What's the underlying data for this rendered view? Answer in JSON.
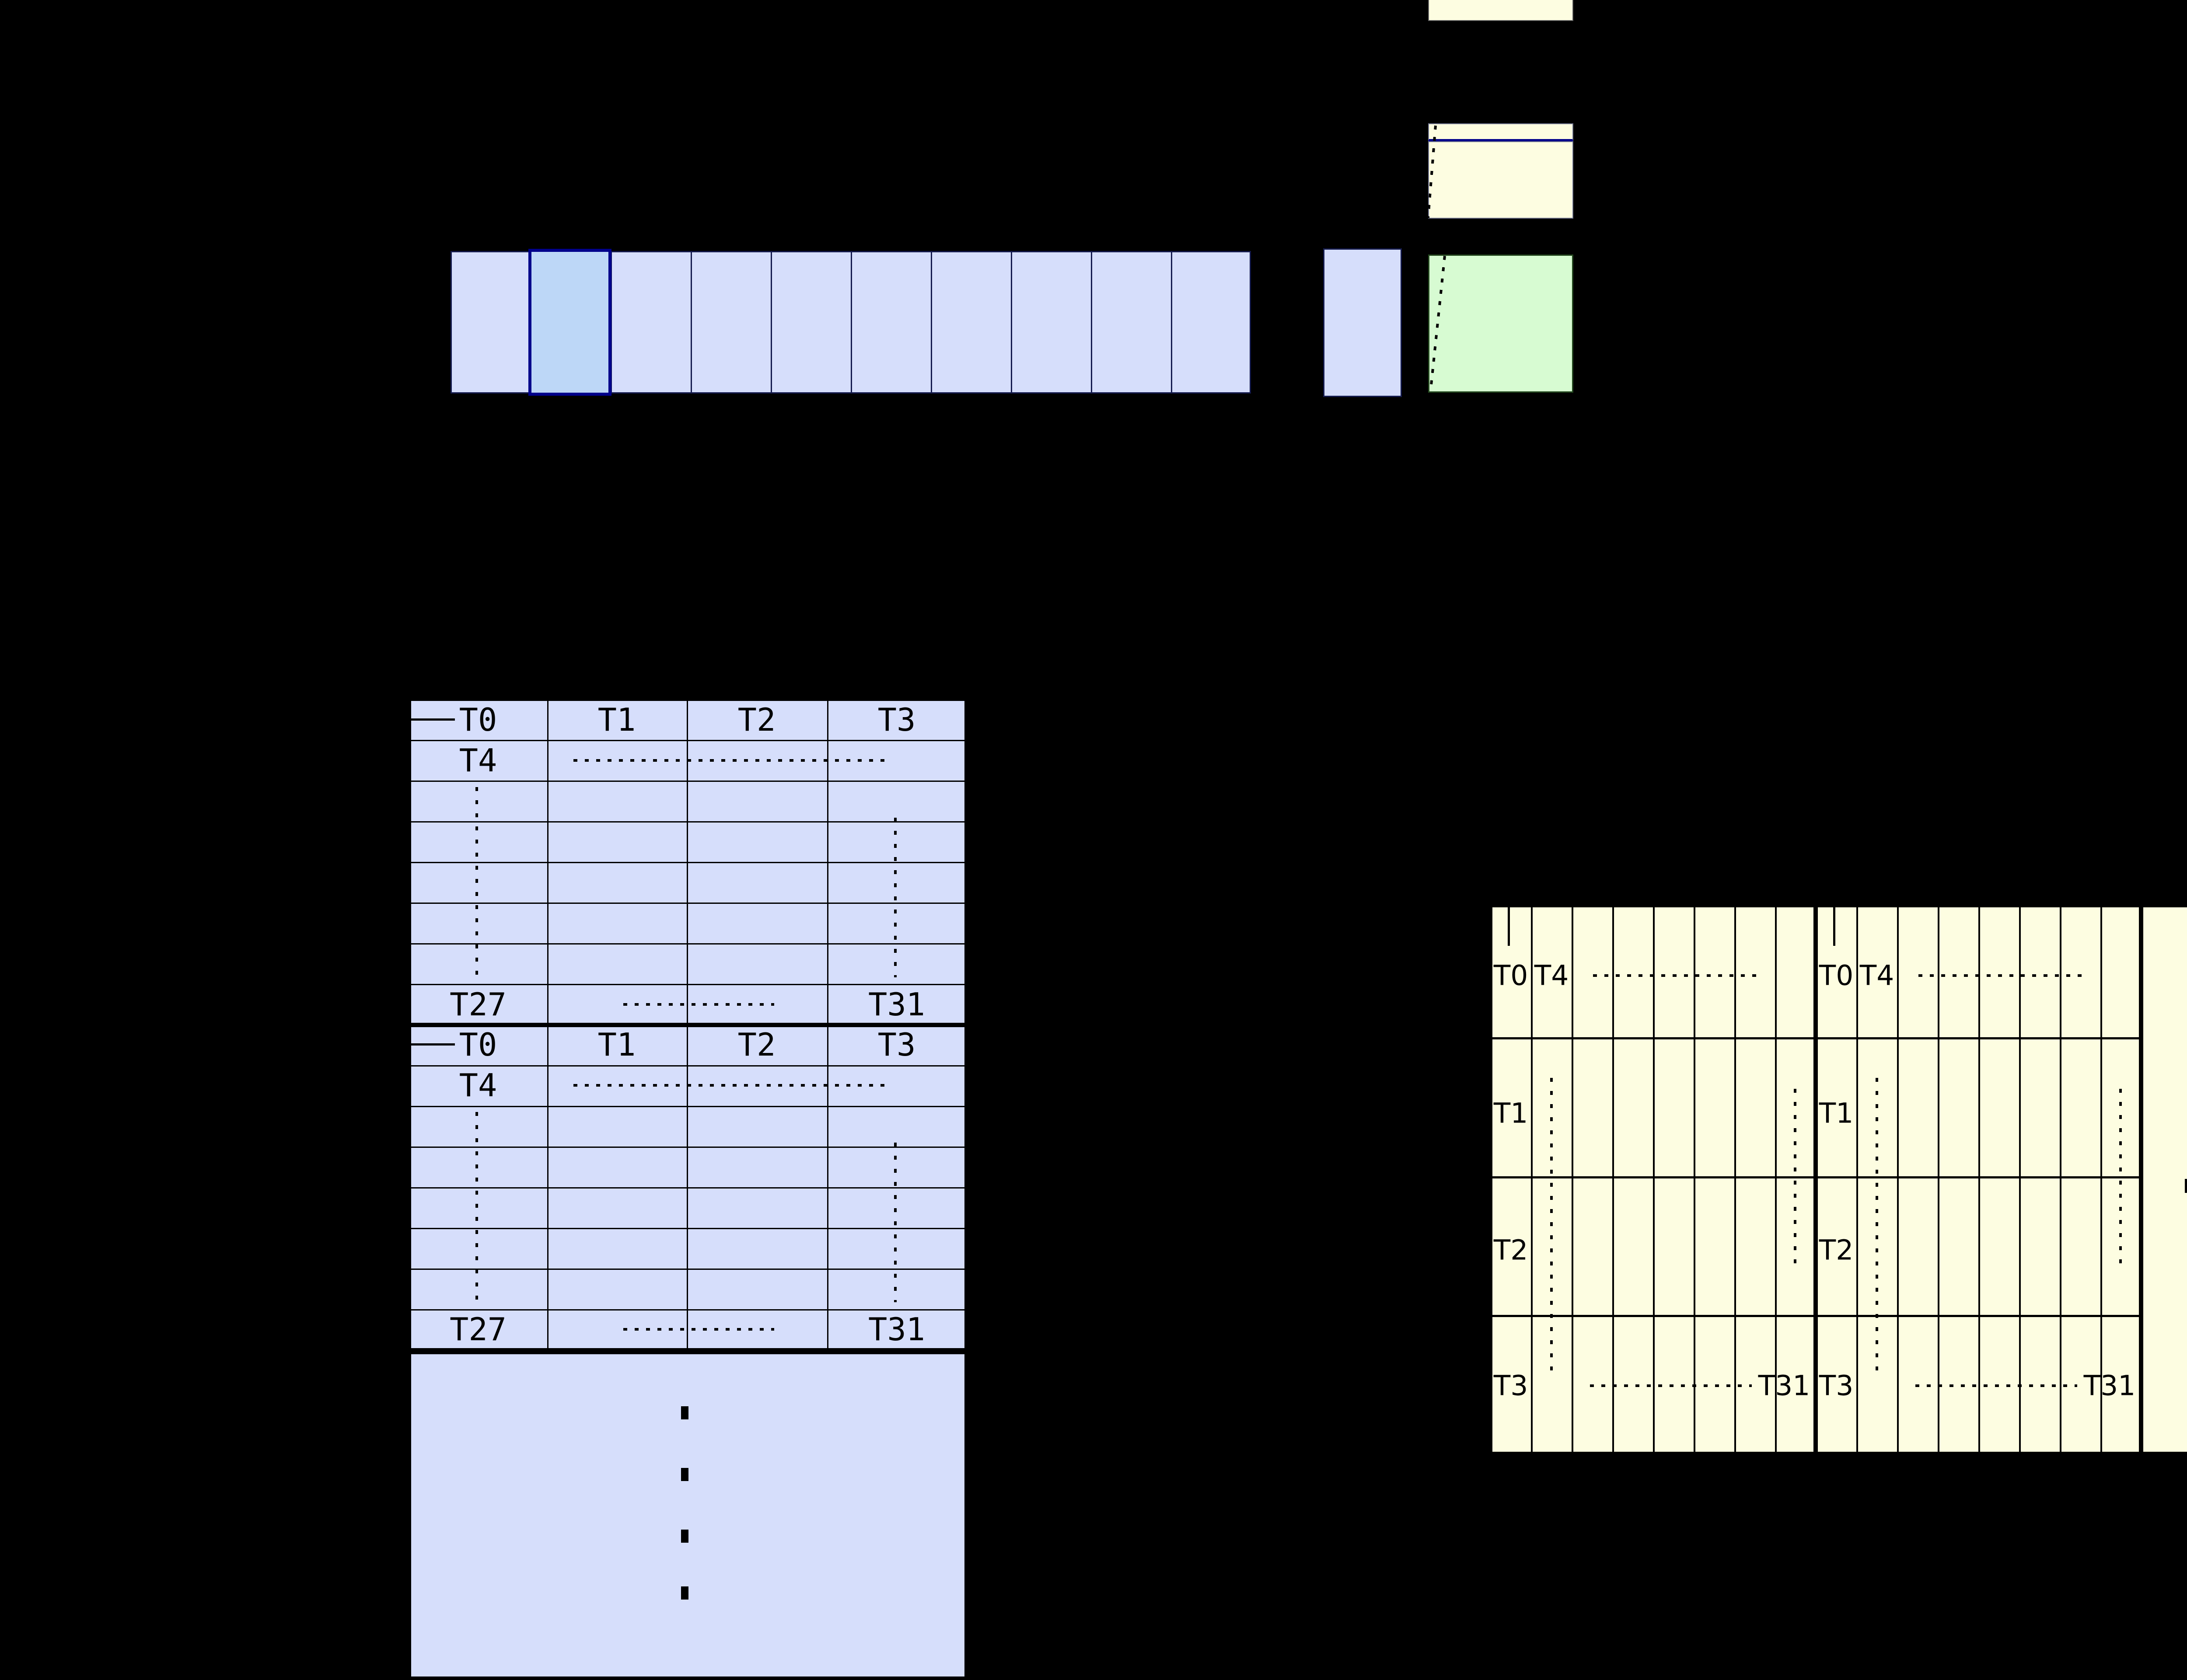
{
  "diagram": {
    "background": "#000000",
    "colors": {
      "cell_blue": "#d6defb",
      "highlight_blue": "#bdd7f7",
      "highlight_border": "#00008b",
      "pale_yellow": "#fdfde1",
      "pale_green": "#d7fbd2",
      "grid_line": "#000000"
    },
    "memory_row": {
      "box_count": 11,
      "highlighted_box_index": 1
    },
    "left_table": {
      "header": [
        "T0",
        "T1",
        "T2",
        "T3"
      ],
      "t4": "T4",
      "t27": "T27",
      "t31": "T31"
    },
    "right_table": {
      "t0": "T0",
      "t4": "T4",
      "t1": "T1",
      "t2": "T2",
      "t3": "T3",
      "t31": "T31"
    }
  }
}
